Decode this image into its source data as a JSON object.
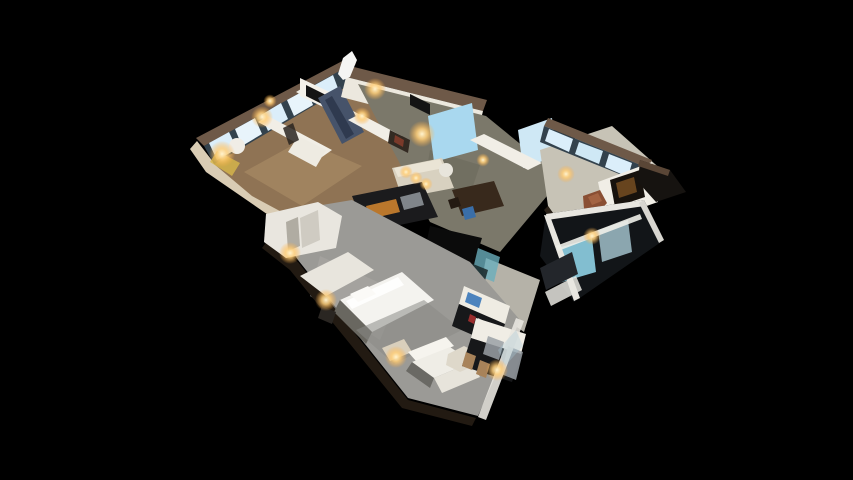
{
  "canvas": {
    "width": 853,
    "height": 480,
    "background": "#000000"
  },
  "scene": {
    "description": "3D dollhouse cutaway view of a furnished apartment floor plan, viewed from above at an angle, floating on a black background. Upper-left wing: bedrooms and bath with bright window wall and warm wood floors, dark marble feature wall, wall TVs. Center: living-dining area with cream sofa, dark dining table, dark kitchen counters with amber cabinet fronts. Right wing: den with brown leather chair, blue desk chair, media wall, window band and glass balcony below. Bottom wing: bedroom suite with large white bed, gray carpet, white sofa, hex coffee table and dark kitchenette with stools. Warm lamp glows scattered throughout.",
    "palette": {
      "background": "#000000",
      "wall_top_cut": "#6e5948",
      "wall_face_white": "#f1eee6",
      "exterior_cut_cream": "#d9ccb4",
      "wood_floor": "#8f7354",
      "olive_floor": "#7b786a",
      "terrazzo_floor": "#c7c3b6",
      "carpet_gray": "#9b9a96",
      "window_glass": "#dbeefa",
      "window_blue": "#a9d8ef",
      "mullion_dark": "#33424d",
      "balcony_cyan": "#8fd0e4",
      "counter_dark": "#17181a",
      "cabinet_amber": "#c87f2e",
      "marble_dark": "#46536a",
      "chair_brown": "#8a4f33",
      "chair_blue": "#3a6ea8",
      "lamp_glow": "#ffcf7a"
    },
    "shapes": [
      {
        "name": "upper-wing-sw-cut-edge",
        "pts": "197,141 214,163 330,238 322,252 206,172 190,149",
        "fill": "#d9ccb4"
      },
      {
        "name": "upper-wing-wood-floor",
        "pts": "214,164 356,80 430,112 448,150 330,238 252,196",
        "fill": "#8f7354"
      },
      {
        "name": "upper-wing-floor-highlight",
        "pts": "244,172 302,140 362,166 302,206",
        "fill": "#a98c66",
        "op": 0.65
      },
      {
        "name": "upper-window-wall-top",
        "pts": "196,138 348,58 356,64 204,146",
        "fill": "#6e5948"
      },
      {
        "name": "upper-window-mullion-strip",
        "pts": "204,146 352,64 358,80 214,164",
        "fill": "#33424d"
      },
      {
        "name": "upper-window-pane-1",
        "pts": "209,143 229,132 237,149 217,160",
        "fill": "#dbeefa"
      },
      {
        "name": "upper-window-pane-2",
        "pts": "235,129 255,118 262,134 242,146",
        "fill": "#e8f4fb"
      },
      {
        "name": "upper-window-pane-3",
        "pts": "261,115 281,103 288,119 268,131",
        "fill": "#dbeefa"
      },
      {
        "name": "upper-window-pane-4",
        "pts": "287,100 307,89 313,105 294,116",
        "fill": "#e8f4fb"
      },
      {
        "name": "upper-window-pane-5",
        "pts": "313,86 333,75 339,91 319,101",
        "fill": "#dbeefa"
      },
      {
        "name": "upper-interior-wall-a",
        "pts": "258,122 268,116 332,150 322,157",
        "fill": "#f1eee6"
      },
      {
        "name": "upper-interior-wall-b",
        "pts": "296,92 306,86 370,120 360,127",
        "fill": "#efece4"
      },
      {
        "name": "upper-tv-wall",
        "pts": "300,78 338,96 338,114 300,96",
        "fill": "#f4f1ea"
      },
      {
        "name": "upper-wall-tv",
        "pts": "306,85 332,98 332,109 306,96",
        "fill": "#141414"
      },
      {
        "name": "marble-feature-wall",
        "pts": "318,98 340,86 364,132 342,144",
        "fill": "#46536a"
      },
      {
        "name": "marble-streaks",
        "pts": "325,100 332,96 354,134 346,139",
        "fill": "#2b364a",
        "op": 0.85
      },
      {
        "name": "round-side-table",
        "circle": [
          237,
          146,
          8
        ],
        "fill": "#f0ede6"
      },
      {
        "name": "yellow-lit-nook",
        "pts": "217,151 240,163 232,176 210,162",
        "fill": "#d8b84a",
        "op": 0.8
      },
      {
        "name": "white-bathtub",
        "pts": "298,136 326,150 316,167 288,152",
        "fill": "#eeebe2"
      },
      {
        "name": "upper-doorway-gap",
        "pts": "283,128 293,123 299,140 289,145",
        "fill": "#2a2520",
        "op": 0.85
      },
      {
        "name": "top-rooms-wall-cut",
        "pts": "350,66 487,100 483,111 346,77",
        "fill": "#6e5948"
      },
      {
        "name": "top-rooms-wall-face",
        "pts": "346,77 483,111 478,132 341,97",
        "fill": "#ece8de"
      },
      {
        "name": "ceiling-sail-fragment",
        "pts": "338,74 343,58 352,51 357,60 350,77 343,80",
        "fill": "#f5f5f3"
      },
      {
        "name": "living-room-floor",
        "pts": "358,84 486,116 562,178 500,252 430,222 398,160",
        "fill": "#7b786a"
      },
      {
        "name": "living-floor-shade",
        "pts": "430,150 480,165 470,195 425,180",
        "fill": "#6b695c",
        "op": 0.6
      },
      {
        "name": "living-window-large",
        "pts": "428,116 472,103 478,150 434,162",
        "fill": "#a9d8ef"
      },
      {
        "name": "living-window-2",
        "pts": "518,130 552,118 557,156 523,168",
        "fill": "#cfe8f5"
      },
      {
        "name": "living-interior-wall-a",
        "pts": "348,120 360,114 402,136 390,143",
        "fill": "#f1eee6"
      },
      {
        "name": "living-wall-tv",
        "pts": "410,94 430,104 430,115 410,105",
        "fill": "#141414"
      },
      {
        "name": "living-interior-wall-b",
        "pts": "470,140 484,134 542,163 528,170",
        "fill": "#f1eee6"
      },
      {
        "name": "framed-art",
        "pts": "390,130 410,140 408,153 388,143",
        "fill": "#332a22"
      },
      {
        "name": "framed-art-image",
        "pts": "395,135 404,140 403,147 394,142",
        "fill": "#7a3a2a"
      },
      {
        "name": "cream-sofa-living",
        "pts": "392,168 442,158 454,188 402,198",
        "fill": "#d8d1c0"
      },
      {
        "name": "cream-sofa-top",
        "pts": "394,168 440,159 444,168 398,177",
        "fill": "#efe9da",
        "op": 0.8
      },
      {
        "name": "round-pouf",
        "circle": [
          446,
          170,
          7
        ],
        "fill": "#e8e5dc"
      },
      {
        "name": "dining-table",
        "pts": "452,190 494,181 504,206 462,216",
        "fill": "#38291c"
      },
      {
        "name": "dining-chair-dark",
        "pts": "448,200 458,197 461,206 451,209",
        "fill": "#241a12"
      },
      {
        "name": "dining-chair-blue",
        "pts": "462,209 473,206 476,217 465,220",
        "fill": "#3a6ea8"
      },
      {
        "name": "kitchen-counter-dark",
        "pts": "352,196 422,182 438,217 366,232",
        "fill": "#1b1b1d"
      },
      {
        "name": "kitchen-cabinet-amber",
        "pts": "366,206 396,199 400,212 370,219",
        "fill": "#c87f2e",
        "op": 0.92
      },
      {
        "name": "kitchen-appliance-steel",
        "pts": "400,197 420,192 424,205 404,210",
        "fill": "#9aa0a6",
        "op": 0.8
      },
      {
        "name": "hallway-dark-void",
        "pts": "430,226 482,238 472,270 424,254",
        "fill": "#0b0b0b"
      },
      {
        "name": "hall-bathroom-floor",
        "pts": "486,258 540,280 524,332 478,300",
        "fill": "#b5b2a8"
      },
      {
        "name": "shower-glass-teal",
        "pts": "478,248 500,257 494,282 472,273",
        "fill": "#6aaebc",
        "op": 0.8
      },
      {
        "name": "bathtub-dark",
        "pts": "468,262 488,270 484,284 464,276",
        "fill": "#1d2d30",
        "op": 0.9
      },
      {
        "name": "living-bottom-wall-cut",
        "pts": "340,206 430,246 429,251 339,211",
        "fill": "#6e5948"
      },
      {
        "name": "living-bottom-wall-face",
        "pts": "340,210 430,250 427,262 336,223",
        "fill": "#eceadf"
      },
      {
        "name": "living-bottom-wall-ext",
        "pts": "430,248 468,264 465,274 427,258",
        "fill": "#e5e1d6"
      },
      {
        "name": "right-wing-terrazzo-floor",
        "pts": "540,150 612,126 664,172 640,214 578,248 548,206",
        "fill": "#c7c3b6"
      },
      {
        "name": "right-wing-sw-cut",
        "pts": "548,206 578,248 574,252 544,210",
        "fill": "#2a2118"
      },
      {
        "name": "right-window-wall-top",
        "pts": "548,118 652,160 648,168 544,126",
        "fill": "#6e5948"
      },
      {
        "name": "right-window-mullion-strip",
        "pts": "544,126 648,168 644,184 540,142",
        "fill": "#33424d"
      },
      {
        "name": "right-window-pane-1",
        "pts": "549,129 573,139 569,152 545,141",
        "fill": "#dbeefa"
      },
      {
        "name": "right-window-pane-2",
        "pts": "579,142 603,151 599,164 575,154",
        "fill": "#cfe8f5"
      },
      {
        "name": "right-window-pane-3",
        "pts": "609,154 632,163 628,177 605,167",
        "fill": "#dbeefa"
      },
      {
        "name": "den-media-wall",
        "pts": "598,182 652,162 658,202 606,220",
        "fill": "#f1eee6"
      },
      {
        "name": "den-tv-dark",
        "pts": "610,180 640,170 645,197 615,207",
        "fill": "#17120d"
      },
      {
        "name": "den-tv-amber-glow",
        "pts": "616,183 634,177 637,192 619,198",
        "fill": "#8a5a26",
        "op": 0.7
      },
      {
        "name": "leather-chair-brown",
        "pts": "583,196 600,190 607,203 598,213 584,209",
        "fill": "#8a4f33"
      },
      {
        "name": "leather-chair-highlight",
        "pts": "588,197 598,193 602,201 592,205",
        "fill": "#a96846",
        "op": 0.8
      },
      {
        "name": "desk-frame-dark",
        "pts": "596,214 620,207 624,217 600,224",
        "fill": "#20242a"
      },
      {
        "name": "desk-chair-blue",
        "pts": "600,217 614,213 617,227 603,231",
        "fill": "#3a6ea8"
      },
      {
        "name": "roof-wedge-dark",
        "pts": "640,160 670,170 686,192 656,202 638,182",
        "fill": "#161310"
      },
      {
        "name": "roof-wedge-edge",
        "pts": "640,160 670,170 668,176 638,166",
        "fill": "#5a4636"
      },
      {
        "name": "balcony-dark-base",
        "pts": "546,214 644,200 664,240 574,302 540,256",
        "fill": "#121518"
      },
      {
        "name": "balcony-glass-cyan-1",
        "pts": "558,248 592,238 596,272 562,282",
        "fill": "#8fd0e4",
        "op": 0.9
      },
      {
        "name": "balcony-glass-cyan-2",
        "pts": "598,230 628,220 632,252 602,262",
        "fill": "#bfe4f0",
        "op": 0.7
      },
      {
        "name": "balcony-frame-top",
        "pts": "546,214 644,200 645,206 547,220",
        "fill": "#e8e6e0"
      },
      {
        "name": "balcony-frame-left",
        "pts": "544,215 550,216 580,298 574,301",
        "fill": "#e8e6e0"
      },
      {
        "name": "balcony-frame-right",
        "pts": "644,200 664,240 659,243 639,203",
        "fill": "#d8d6d0"
      },
      {
        "name": "balcony-rail",
        "pts": "556,246 640,214 642,219 558,251",
        "fill": "#f0efe9",
        "op": 0.9
      },
      {
        "name": "slatted-bench-dark",
        "pts": "540,268 572,252 578,274 546,290",
        "fill": "#23262b"
      },
      {
        "name": "balcony-walk-strip",
        "pts": "545,292 576,276 582,290 551,306",
        "fill": "#e8e6e0",
        "op": 0.85
      },
      {
        "name": "bottom-wing-carpet-floor",
        "pts": "268,214 352,200 470,262 520,320 478,416 408,398 298,260",
        "fill": "#9b9a96"
      },
      {
        "name": "bottom-carpet-highlight",
        "pts": "320,256 400,292 380,340 310,296",
        "fill": "#aaa9a4",
        "op": 0.6
      },
      {
        "name": "bottom-wing-sw-cut",
        "pts": "268,240 298,262 408,400 476,418 472,426 402,408 290,270 262,248",
        "fill": "#221a12"
      },
      {
        "name": "closet-block-white",
        "pts": "266,214 318,202 342,216 336,248 286,258 264,242",
        "fill": "#e9e6df"
      },
      {
        "name": "closet-shade-panel",
        "pts": "300,218 318,210 320,240 302,248",
        "fill": "#cfcbc2"
      },
      {
        "name": "closet-dark-gap",
        "pts": "286,222 298,217 300,246 288,251",
        "fill": "#8a8579",
        "op": 0.6
      },
      {
        "name": "bed-headboard-panel",
        "pts": "300,276 348,252 374,270 326,296",
        "fill": "#e8e5dd"
      },
      {
        "name": "bed-mattress-white",
        "pts": "340,300 402,272 434,300 372,332",
        "fill": "#f4f3ef"
      },
      {
        "name": "bed-duvet-highlight",
        "pts": "346,301 398,277 404,285 352,309",
        "fill": "#ffffff",
        "op": 0.85
      },
      {
        "name": "bed-pillows",
        "pts": "350,294 368,286 376,294 358,302",
        "fill": "#fbfaf7"
      },
      {
        "name": "bed-base-shadow",
        "pts": "340,300 372,332 366,344 334,312",
        "fill": "#696760"
      },
      {
        "name": "nightstand-dark",
        "pts": "322,306 336,312 332,324 318,318",
        "fill": "#2a2622"
      },
      {
        "name": "area-rug-gray",
        "pts": "356,330 424,300 462,330 394,364",
        "fill": "#8b8b86",
        "op": 0.55
      },
      {
        "name": "side-table-wood",
        "pts": "382,348 404,339 412,352 390,361",
        "fill": "#d9cfbc"
      },
      {
        "name": "sofa-back-white",
        "pts": "408,352 446,337 454,346 416,361",
        "fill": "#f6f4ee"
      },
      {
        "name": "sofa-seat-white",
        "pts": "412,362 450,347 472,362 434,378",
        "fill": "#efede6"
      },
      {
        "name": "sofa-chaise",
        "pts": "434,378 472,362 480,377 442,393",
        "fill": "#e7e4db"
      },
      {
        "name": "sofa-shadow",
        "pts": "412,362 434,378 430,388 406,371",
        "fill": "#55544e",
        "op": 0.7
      },
      {
        "name": "hex-coffee-table",
        "pts": "448,354 464,346 478,353 476,365 460,372 446,365",
        "fill": "#ded8ca"
      },
      {
        "name": "media-console-uppers",
        "pts": "464,286 510,306 505,324 459,304",
        "fill": "#efece3"
      },
      {
        "name": "media-blue-screen",
        "pts": "468,292 482,298 479,308 465,302",
        "fill": "#3a78b8",
        "op": 0.9
      },
      {
        "name": "minibar-counter-dark",
        "pts": "459,304 505,324 498,346 452,326",
        "fill": "#17181a"
      },
      {
        "name": "bottle-red",
        "pts": "470,314 476,317 474,324 468,321",
        "fill": "#a83030",
        "op": 0.9
      },
      {
        "name": "bottle-white",
        "pts": "478,318 484,321 482,328 476,325",
        "fill": "#d8d8d8",
        "op": 0.9
      },
      {
        "name": "kitchenette-uppers-white",
        "pts": "476,318 526,334 521,354 471,338",
        "fill": "#f0ede5"
      },
      {
        "name": "kitchenette-counter-dark",
        "pts": "471,338 521,354 512,382 462,366",
        "fill": "#17181a"
      },
      {
        "name": "kitchenette-fridge-steel",
        "pts": "508,346 523,352 516,380 501,374",
        "fill": "#9aa0a6",
        "op": 0.85
      },
      {
        "name": "kitchenette-range-steel",
        "pts": "488,336 504,342 499,360 483,354",
        "fill": "#9aa0a6",
        "op": 0.85
      },
      {
        "name": "bar-stool-1",
        "pts": "466,352 476,356 472,370 462,366",
        "fill": "#a8835a"
      },
      {
        "name": "bar-stool-2",
        "pts": "480,360 490,364 486,378 476,374",
        "fill": "#a8835a"
      },
      {
        "name": "glass-wall-frame",
        "pts": "516,318 524,321 486,420 478,417",
        "fill": "#e8e6df",
        "op": 0.9
      },
      {
        "name": "glass-wall-pane",
        "pts": "498,350 516,330 523,346 505,366",
        "fill": "#a8c8d8",
        "op": 0.35
      }
    ],
    "lights": [
      {
        "name": "lamp-glow-nook",
        "x": 222,
        "y": 154,
        "r": 6
      },
      {
        "name": "lamp-glow-bedroom-wall",
        "x": 262,
        "y": 117,
        "r": 5
      },
      {
        "name": "ceiling-light-1",
        "x": 270,
        "y": 101,
        "r": 3
      },
      {
        "name": "lamp-glow-hall",
        "x": 375,
        "y": 89,
        "r": 5
      },
      {
        "name": "sconce-glow-art",
        "x": 362,
        "y": 116,
        "r": 4
      },
      {
        "name": "pendant-glow-living",
        "x": 422,
        "y": 134,
        "r": 6
      },
      {
        "name": "spot-light-1",
        "x": 406,
        "y": 172,
        "r": 3
      },
      {
        "name": "spot-light-2",
        "x": 416,
        "y": 178,
        "r": 3
      },
      {
        "name": "spot-light-3",
        "x": 426,
        "y": 184,
        "r": 3
      },
      {
        "name": "lamp-glow-den",
        "x": 566,
        "y": 174,
        "r": 4
      },
      {
        "name": "lamp-glow-balcony",
        "x": 592,
        "y": 236,
        "r": 4
      },
      {
        "name": "lamp-glow-bedside",
        "x": 326,
        "y": 300,
        "r": 5
      },
      {
        "name": "lamp-glow-side-table",
        "x": 396,
        "y": 357,
        "r": 5
      },
      {
        "name": "lamp-glow-closet",
        "x": 290,
        "y": 253,
        "r": 5
      },
      {
        "name": "lamp-glow-kitchenette",
        "x": 497,
        "y": 370,
        "r": 5
      },
      {
        "name": "window-glint",
        "x": 483,
        "y": 160,
        "r": 3
      }
    ],
    "glow_colors": {
      "inner": "#fff3cf",
      "mid": "#ffcf7a",
      "outer": "#ffad3f"
    }
  }
}
